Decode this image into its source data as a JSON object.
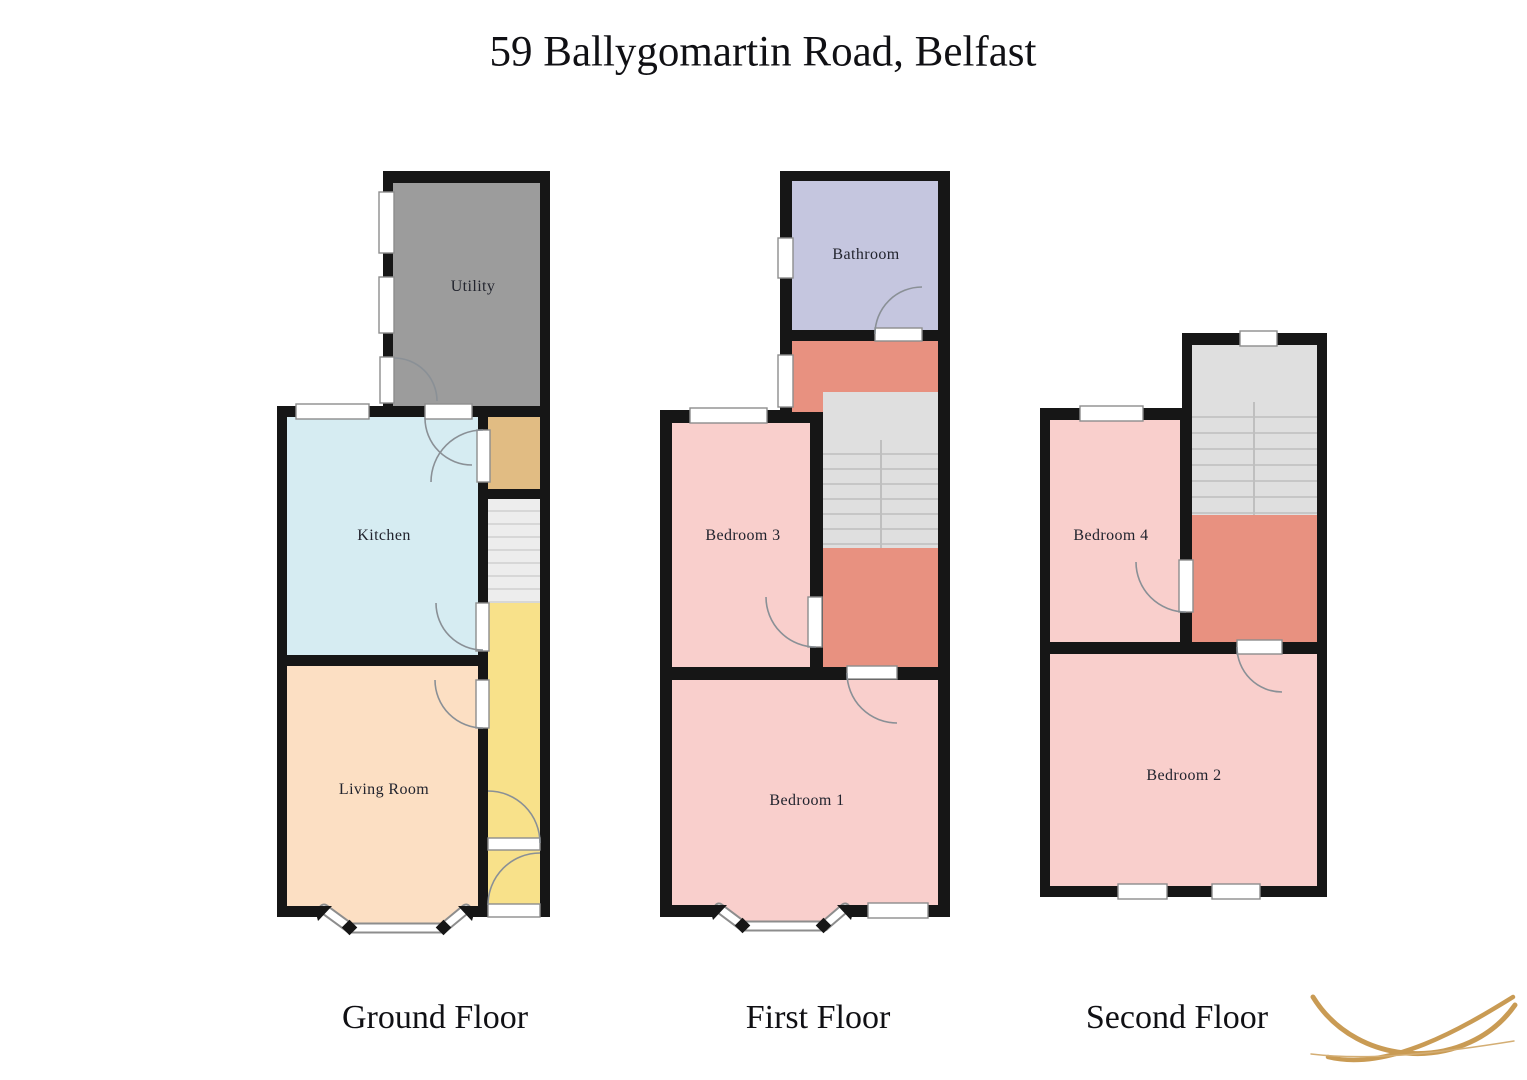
{
  "title": "59 Ballygomartin Road, Belfast",
  "rooms": {
    "utility": "Utility",
    "kitchen": "Kitchen",
    "living_room": "Living Room",
    "bathroom": "Bathroom",
    "bedroom1": "Bedroom 1",
    "bedroom2": "Bedroom 2",
    "bedroom3": "Bedroom 3",
    "bedroom4": "Bedroom 4"
  },
  "floor_labels": {
    "ground": "Ground Floor",
    "first": "First Floor",
    "second": "Second Floor"
  },
  "colors": {
    "wall": "#161616",
    "utility": "#9c9c9c",
    "kitchen": "#d6ecf2",
    "living_room": "#fcdfc3",
    "hallway": "#f8e18a",
    "vestibule": "#e1bc83",
    "bathroom": "#c5c6df",
    "bedroom": "#f9cfcc",
    "landing": "#e89180",
    "stairs": "#e0e0e0",
    "window": "#ffffff",
    "logo_gold": "#c99b54"
  }
}
